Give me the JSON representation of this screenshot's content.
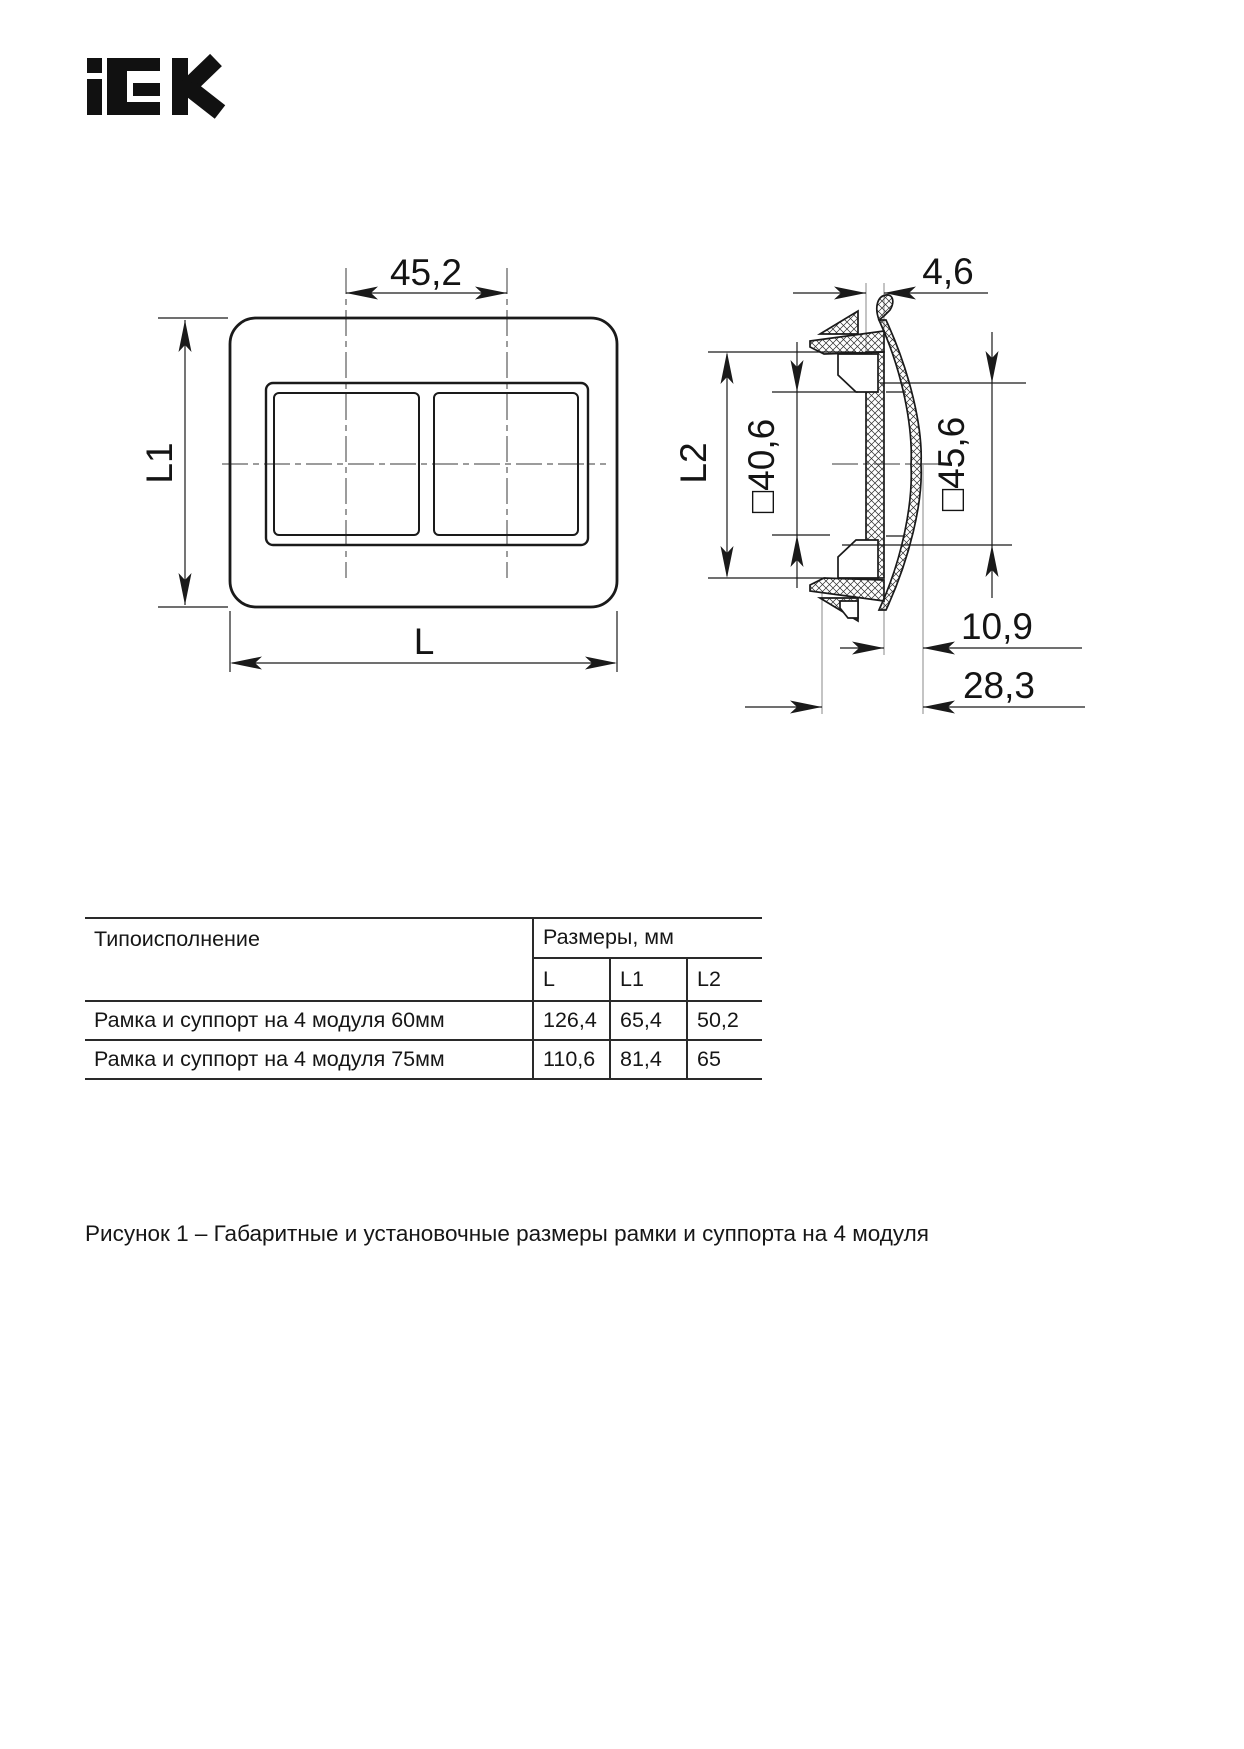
{
  "logo": {
    "brand": "iEK"
  },
  "figure": {
    "front_view": {
      "dim_top": "45,2",
      "dim_height": "L1",
      "dim_width": "L"
    },
    "side_view": {
      "dim_top": "4,6",
      "dim_l2": "L2",
      "dim_inner": "□40,6",
      "dim_outer": "□45,6",
      "dim_offset": "10,9",
      "dim_depth": "28,3"
    }
  },
  "table": {
    "col1_header": "Типоисполнение",
    "col_group_header": "Размеры, мм",
    "sub_headers": [
      "L",
      "L1",
      "L2"
    ],
    "rows": [
      {
        "name": "Рамка и суппорт на 4 модуля 60мм",
        "L": "126,4",
        "L1": "65,4",
        "L2": "50,2"
      },
      {
        "name": "Рамка и суппорт на 4 модуля 75мм",
        "L": "110,6",
        "L1": "81,4",
        "L2": "65"
      }
    ]
  },
  "caption": "Рисунок 1 – Габаритные и установочные размеры рамки и суппорта на 4 модуля"
}
